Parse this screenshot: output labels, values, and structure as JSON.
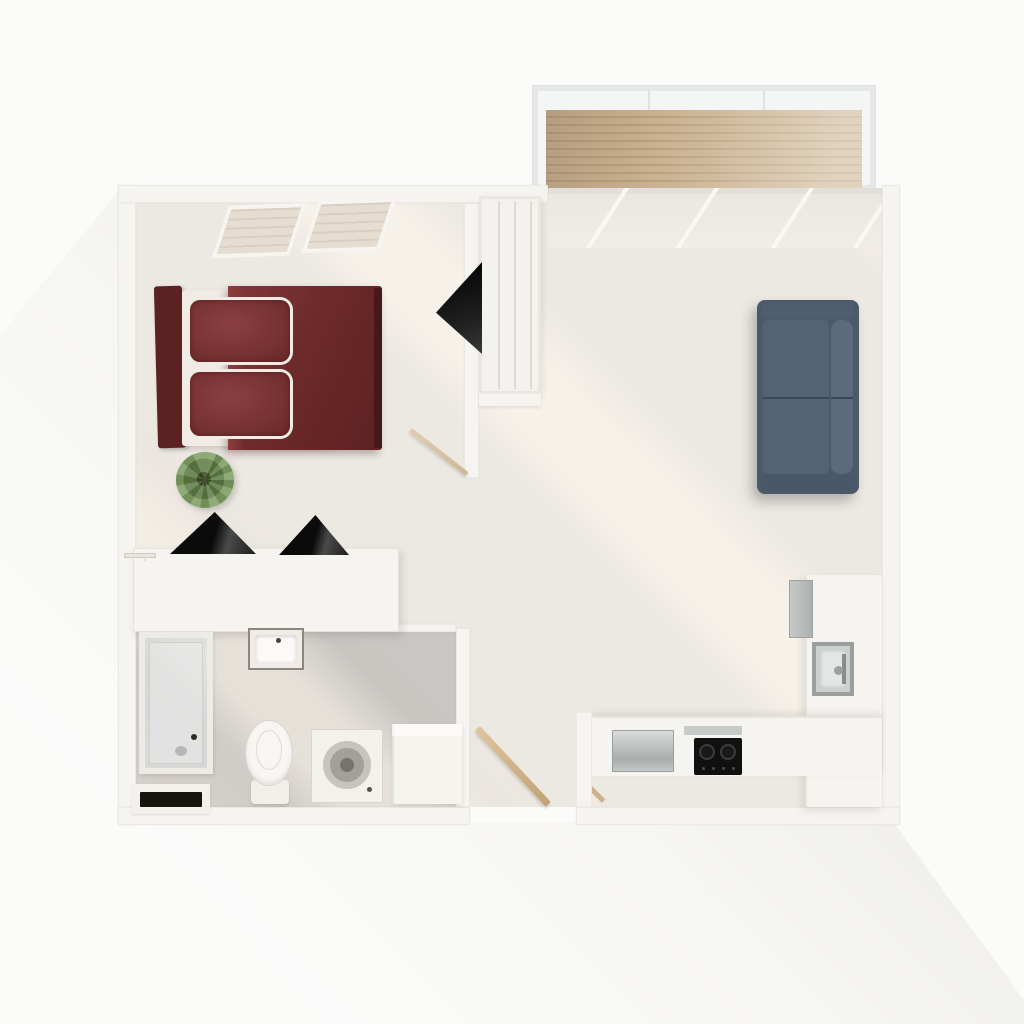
{
  "scene": {
    "title": "Studio apartment 3D floor plan (top-down render)",
    "rooms": [
      {
        "name": "bedroom",
        "furniture": [
          "double bed with dark red duvet",
          "two dark red pillows",
          "headboard",
          "skylight window",
          "potted plant",
          "dresser with four drawers",
          "two black triangular decor objects"
        ]
      },
      {
        "name": "closet",
        "furniture": [
          "white shelving unit",
          "dark open panel"
        ]
      },
      {
        "name": "bathroom",
        "furniture": [
          "glass shower stall",
          "wall washbasin",
          "toilet",
          "washing machine",
          "side cabinet",
          "dark doormat recess"
        ]
      },
      {
        "name": "living-room",
        "furniture": [
          "two-seat navy sofa"
        ]
      },
      {
        "name": "kitchen",
        "furniture": [
          "L-shaped counter",
          "fridge",
          "sink with faucet",
          "black two-burner cooktop",
          "stainless dishwasher top"
        ]
      },
      {
        "name": "balcony",
        "furniture": [
          "wood plank deck",
          "glass railing",
          "sliding glass door"
        ]
      },
      {
        "name": "entry",
        "furniture": [
          "open wood door leaf"
        ]
      }
    ]
  },
  "palette": {
    "bg": "#fbfbfa",
    "wall": "#f6f4f0",
    "floor": "#ece8e2",
    "bathFloor": "#c9c6c3",
    "bed": "#6d2a2a",
    "pillow": "#6f2c2c",
    "sheet": "#f1ebe6",
    "sofa": "#4b5a6b",
    "sofaDark": "#3a4756",
    "deck": "#c9b090",
    "deckLine": "#b99f7f",
    "plant": "#7d9c60",
    "plantDark": "#37441f",
    "black": "#17130f"
  }
}
